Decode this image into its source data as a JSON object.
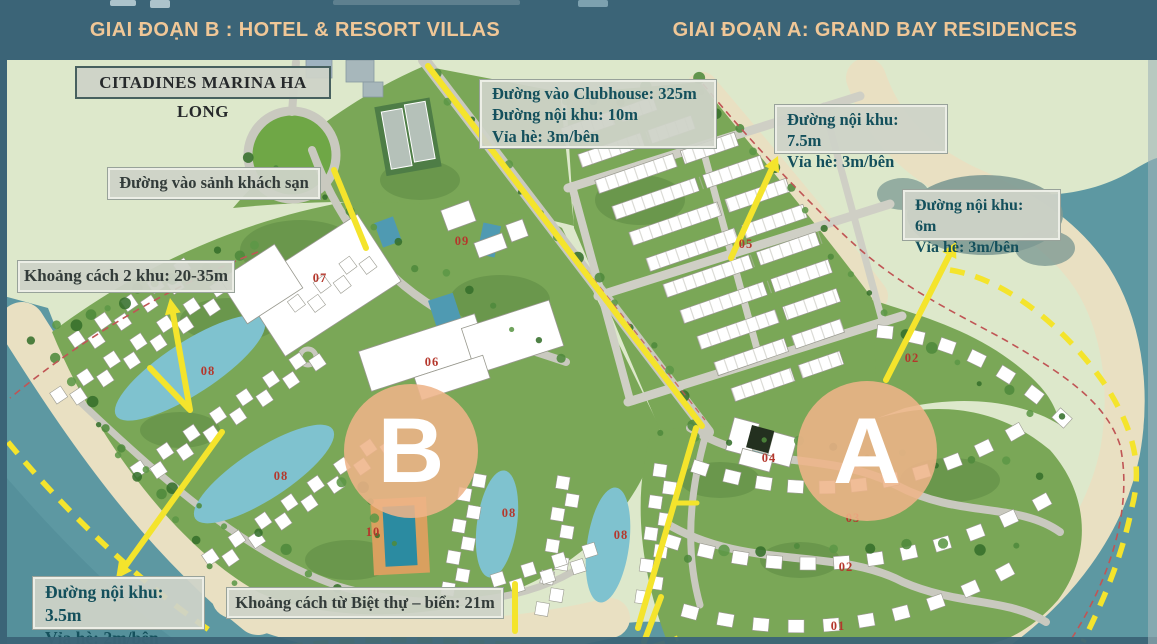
{
  "slide": {
    "phase_b_title": "GIAI ĐOẠN B : HOTEL & RESORT VILLAS",
    "phase_a_title": "GIAI ĐOẠN A: GRAND BAY RESIDENCES",
    "header_bg": "#3b6477",
    "header_text_color": "#f0c797"
  },
  "annotations": {
    "citadines": "CITADINES MARINA HA LONG",
    "clubhouse_road": [
      "Đường vào Clubhouse: 325m",
      "Đường nội khu: 10m",
      "Vỉa hè: 3m/bên"
    ],
    "internal_road_75": [
      "Đường nội khu: 7.5m",
      "Vỉa hè: 3m/bên"
    ],
    "internal_road_6": [
      "Đường nội khu: 6m",
      "Vỉa hè: 3m/bên"
    ],
    "hotel_lobby_road": "Đường vào sảnh khách sạn",
    "zone_gap": "Khoảng cách 2 khu: 20-35m",
    "internal_road_35": [
      "Đường nội khu: 3.5m",
      "Vỉa hè: 2m/bên"
    ],
    "villa_sea_gap": "Khoảng cách từ Biệt thự – biển: 21m"
  },
  "phase_markers": {
    "b": "B",
    "a": "A",
    "circle_color": "#eeb489"
  },
  "zone_numbers": [
    "07",
    "09",
    "06",
    "05",
    "02",
    "04",
    "03",
    "02",
    "01",
    "08",
    "08",
    "08",
    "08",
    "10"
  ],
  "map_colors": {
    "land": "#dde8cb",
    "sea": "#5d98a2",
    "beach": "#e9e0c2",
    "resort_green": "#7aa757",
    "road_highlight": "#f4e42c",
    "boundary_red": "#c05555",
    "number_red": "#b5372c"
  }
}
